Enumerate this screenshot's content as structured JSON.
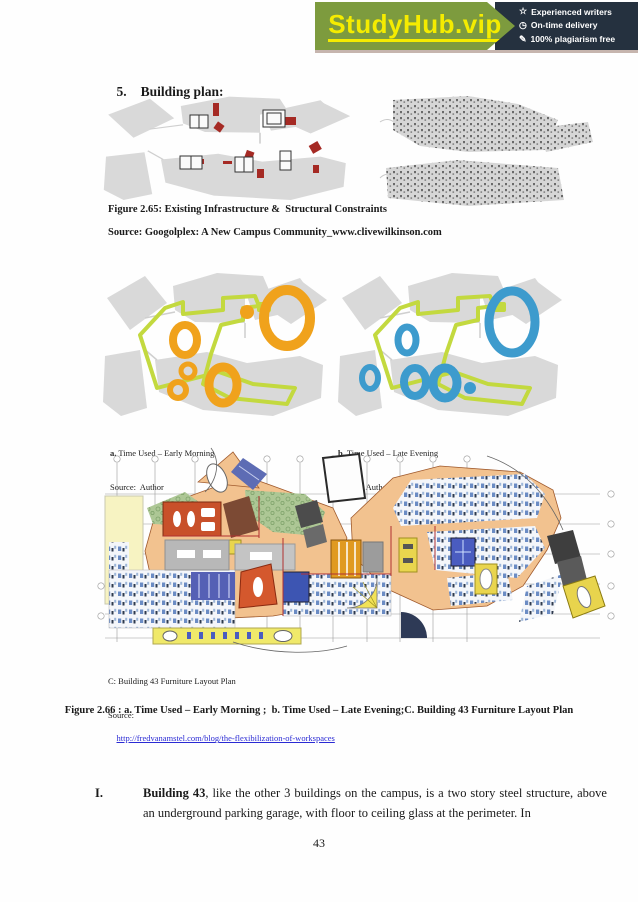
{
  "banner": {
    "brand": "StudyHub.vip",
    "features": [
      {
        "icon": "star-icon",
        "glyph": "☆",
        "label": "Experienced writers"
      },
      {
        "icon": "clock-icon",
        "glyph": "◷",
        "label": "On-time delivery"
      },
      {
        "icon": "plagiarism-icon",
        "glyph": "✎",
        "label": "100% plagiarism free"
      }
    ]
  },
  "heading": {
    "number": "5.",
    "text": "Building plan:"
  },
  "figure_2_65": {
    "caption": "Figure 2.65: Existing Infrastructure &  Structural Constraints",
    "source": "Source: Googolplex: A New Campus Community_www.clivewilkinson.com"
  },
  "figure_2_66": {
    "a_prefix": "a.",
    "a_text": " Time Used – Early Morning",
    "a_source": "Source:  Author",
    "b_prefix": "b.",
    "b_text": " Time Used – Late Evening",
    "b_source": "Source: Author",
    "c_caption": "C: Building 43 Furniture Layout Plan",
    "c_source_label": "Source:",
    "c_source_link": "http://fredvanamstel.com/blog/the-flexibilization-of-workspaces",
    "main_caption": "Figure 2.66 : a. Time Used – Early Morning ;  b. Time Used – Late Evening;C. Building 43 Furniture Layout Plan"
  },
  "body": {
    "item_numeral": "I.",
    "bold_lead": "Building 43",
    "text_rest": ", like the other 3 buildings on the campus, is a two story steel structure, above an underground parking garage, with floor to ceiling glass at the perimeter. In"
  },
  "page_number": "43",
  "colors": {
    "banner_green": "#7d9b3e",
    "banner_navy": "#25313f",
    "brand_yellow": "#f5ec00",
    "morning_orange": "#f0a21c",
    "evening_blue": "#3d9bcd",
    "path_lime": "#c3d93f",
    "campus_gray": "#d9d9d9",
    "constraint_red": "#a52a24",
    "link_blue": "#2a2ad4"
  }
}
